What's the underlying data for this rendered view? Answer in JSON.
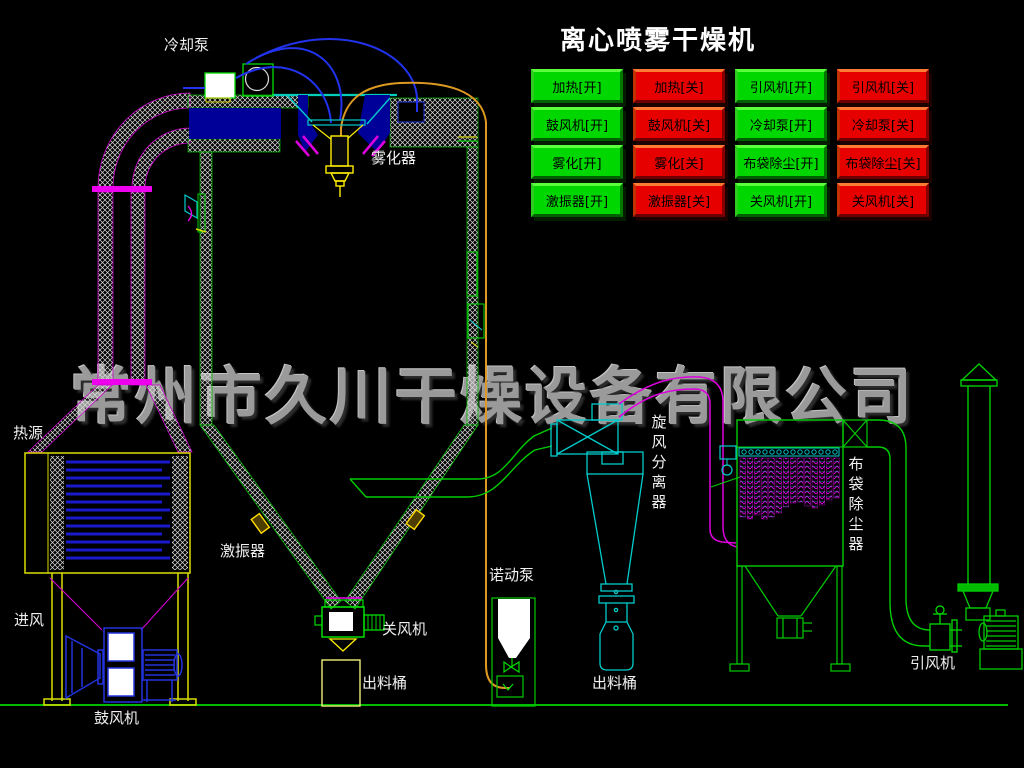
{
  "title": "离心喷雾干燥机",
  "watermark": "常州市久川干燥设备有限公司",
  "control_panel": {
    "buttons": [
      {
        "label": "加热[开]",
        "state": "on",
        "color": "#00d600"
      },
      {
        "label": "加热[关]",
        "state": "off",
        "color": "#e60000"
      },
      {
        "label": "引风机[开]",
        "state": "on",
        "color": "#00d600"
      },
      {
        "label": "引风机[关]",
        "state": "off",
        "color": "#e60000"
      },
      {
        "label": "鼓风机[开]",
        "state": "on",
        "color": "#00d600"
      },
      {
        "label": "鼓风机[关]",
        "state": "off",
        "color": "#e60000"
      },
      {
        "label": "冷却泵[开]",
        "state": "on",
        "color": "#00d600"
      },
      {
        "label": "冷却泵[关]",
        "state": "off",
        "color": "#e60000"
      },
      {
        "label": "雾化[开]",
        "state": "on",
        "color": "#00d600"
      },
      {
        "label": "雾化[关]",
        "state": "off",
        "color": "#e60000"
      },
      {
        "label": "布袋除尘[开]",
        "state": "on",
        "color": "#00d600"
      },
      {
        "label": "布袋除尘[关]",
        "state": "off",
        "color": "#e60000"
      },
      {
        "label": "激振器[开]",
        "state": "on",
        "color": "#00d600"
      },
      {
        "label": "激振器[关]",
        "state": "off",
        "color": "#e60000"
      },
      {
        "label": "关风机[开]",
        "state": "on",
        "color": "#00d600"
      },
      {
        "label": "关风机[关]",
        "state": "off",
        "color": "#e60000"
      }
    ]
  },
  "diagram": {
    "labels": {
      "cooling_pump": "冷却泵",
      "atomizer": "雾化器",
      "heat_source": "热源",
      "air_inlet": "进风",
      "blower": "鼓风机",
      "vibrator": "激振器",
      "rotary_valve": "关风机",
      "discharge_barrel_left": "出料桶",
      "peristaltic_pump": "诺动泵",
      "cyclone": "旋风分离器",
      "discharge_barrel_right": "出料桶",
      "bag_filter": "布袋除尘器",
      "induced_draft_fan": "引风机"
    },
    "colors": {
      "line_green": "#00cc00",
      "line_cyan": "#00cccc",
      "line_magenta": "#dd00dd",
      "line_blue": "#2233dd",
      "line_yellow": "#ffee00",
      "line_orange": "#dd9922",
      "watermark_gray": "#9a9a9a",
      "button_on_green": "#00d600",
      "button_off_red": "#e60000"
    }
  }
}
